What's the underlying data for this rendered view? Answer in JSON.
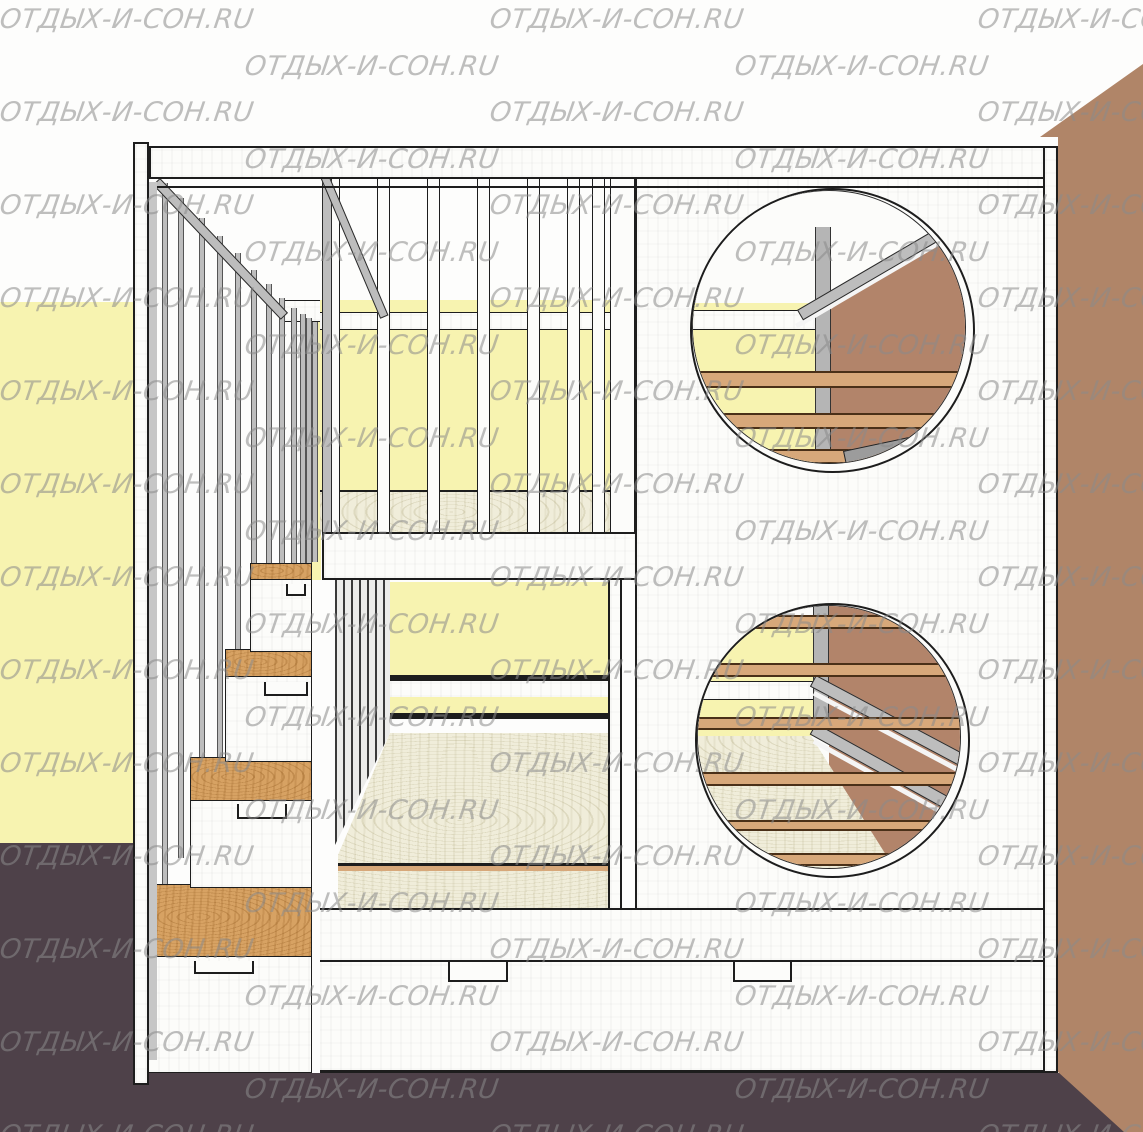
{
  "description": "3D render of a white two-storey children's bunk bed with round porthole windows, slatted guard rails and a drawer staircase, against a yellow wall and a brown wall on a dark floor",
  "watermark": {
    "text": "ОТДЫХ-И-СОН.RU",
    "rows": 25,
    "row_pitch": 46.5,
    "y0": 4,
    "even_row_x": [
      0,
      490,
      978
    ],
    "odd_row_x": [
      245,
      735
    ]
  },
  "colors": {
    "wall_yellow": "#f7f3b0",
    "wall_brown": "#b08568",
    "floor_dark": "#4e4149",
    "panel_white": "#fcfcfa",
    "outline": "#1d1d1d",
    "beam_gray": "#bdbdbd",
    "step_plywood": "#d7a263",
    "mattress_ply": "#f0edda",
    "rail_tan": "#d7a87a",
    "inner_brown": "#b2846a",
    "wm_color": "#8b8b8b"
  }
}
